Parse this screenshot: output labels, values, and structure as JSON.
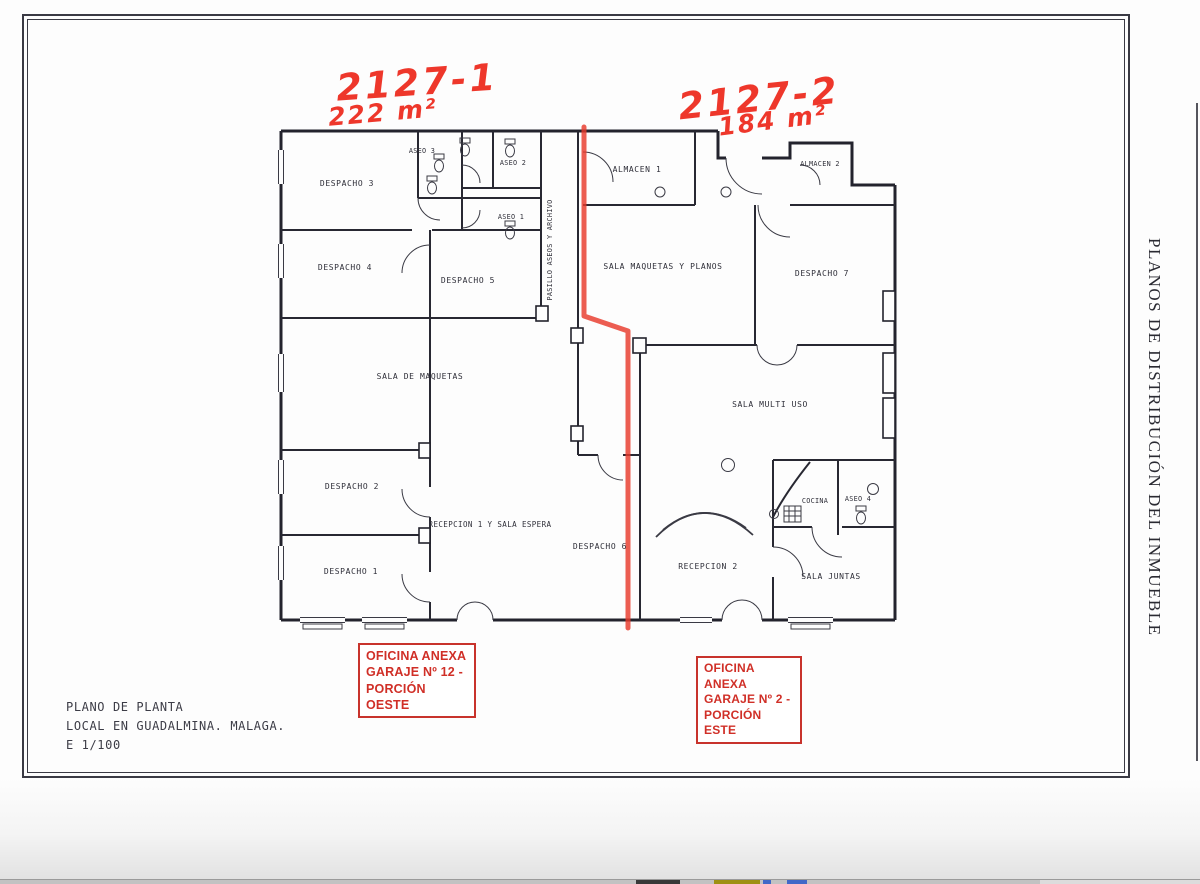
{
  "handwritten": {
    "left_ref": "2127-1",
    "left_area": "222 m²",
    "right_ref": "2127-2",
    "right_area": "184 m²"
  },
  "stamps": {
    "west": [
      "OFICINA ANEXA",
      "GARAJE Nº 12 -",
      "PORCIÓN OESTE"
    ],
    "east": [
      "OFICINA ANEXA",
      "GARAJE Nº 2 -",
      "PORCIÓN ESTE"
    ]
  },
  "title_block": [
    "PLANO DE PLANTA",
    "LOCAL EN GUADALMINA. MALAGA.",
    "E 1/100"
  ],
  "side_caption": "PLANOS DE DISTRIBUCIÓN DEL INMUEBLE",
  "rooms": {
    "despacho_1": "DESPACHO 1",
    "despacho_2": "DESPACHO 2",
    "despacho_3": "DESPACHO 3",
    "despacho_4": "DESPACHO 4",
    "despacho_5": "DESPACHO 5",
    "despacho_6": "DESPACHO 6",
    "despacho_7": "DESPACHO 7",
    "aseo_1": "ASEO 1",
    "aseo_2": "ASEO 2",
    "aseo_3": "ASEO 3",
    "aseo_4": "ASEO 4",
    "almacen_1": "ALMACEN 1",
    "almacen_2": "ALMACEN 2",
    "pasillo": "PASILLO ASEOS Y ARCHIVO",
    "sala_maquetas": "SALA DE MAQUETAS",
    "sala_maquetas_planos": "SALA MAQUETAS Y PLANOS",
    "sala_multiuso": "SALA MULTI USO",
    "recepcion_1": "RECEPCION 1 Y SALA ESPERA",
    "recepcion_2": "RECEPCION 2",
    "cocina": "COCINA",
    "sala_juntas": "SALA JUNTAS"
  },
  "colors": {
    "ink": "#2f2f39",
    "annotation_red": "#ee372b",
    "stamp_red": "#d02f27",
    "paper": "#fdfdfd"
  }
}
